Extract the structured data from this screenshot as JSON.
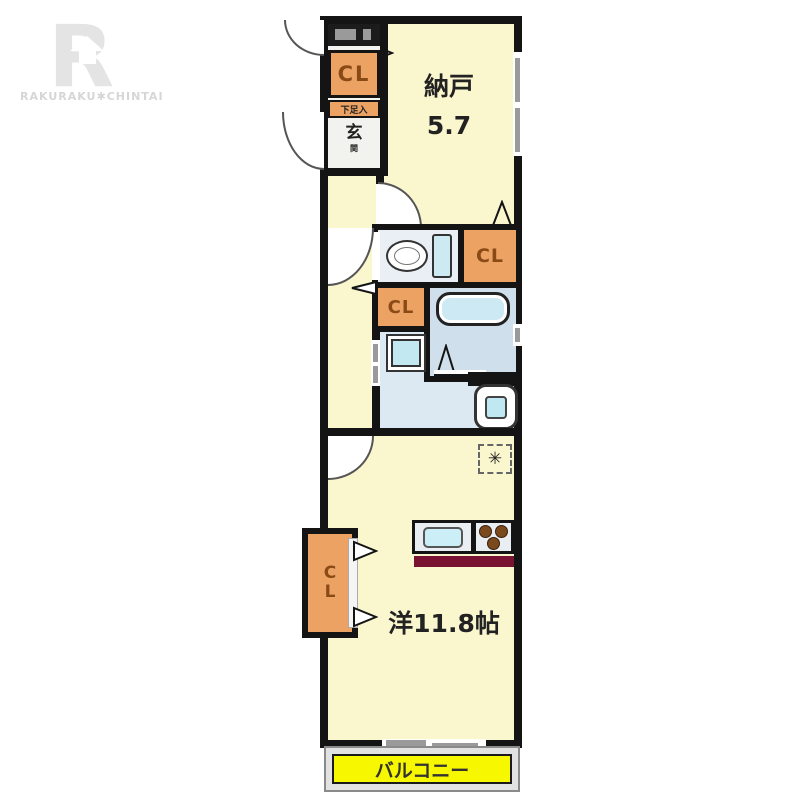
{
  "brand": {
    "letter": "R",
    "name": "RAKURAKU✱CHINTAI"
  },
  "floorplan": {
    "storage_room": {
      "name": "納戸",
      "area": "5.7"
    },
    "main_room": {
      "name": "洋11.8帖"
    },
    "balcony": {
      "name": "バルコニー"
    },
    "entrance": {
      "kanji_main": "玄",
      "kanji_sub": "関"
    },
    "shoe_cabinet": {
      "label": "下足入"
    },
    "closets": {
      "entry_closet": "CL",
      "toilet_side_closet": "CL",
      "washroom_side_closet": "CL",
      "bedroom_closet_letters": [
        "C",
        "L"
      ]
    },
    "aircon_symbol": "✳"
  },
  "colors": {
    "room_cream": "#faf6cd",
    "closet_orange": "#eca263",
    "balcony_yellow": "#f7f700",
    "counter_front_maroon": "#7a1232",
    "water_area_blue": "#dce8f2",
    "wall_black": "#141414",
    "logo_gray": "#e4e4e4"
  }
}
